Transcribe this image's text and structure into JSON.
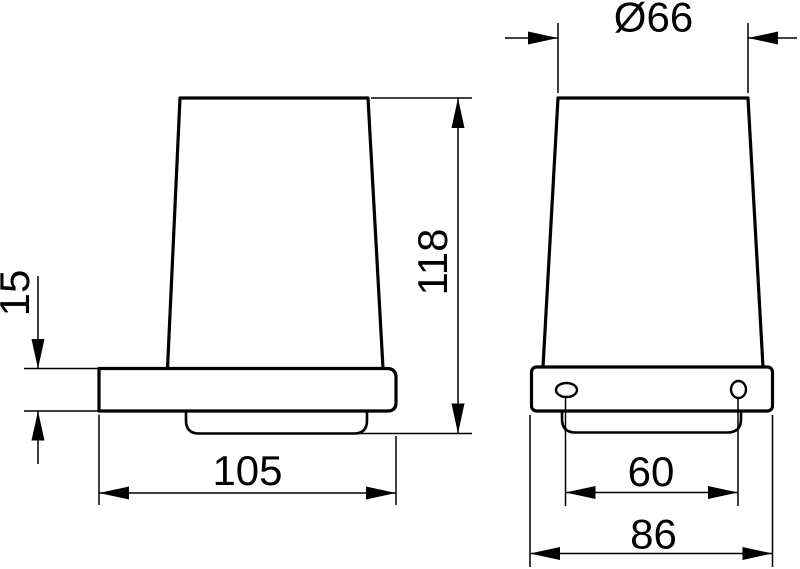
{
  "drawing": {
    "background_color": "#ffffff",
    "line_color": "#000000",
    "views": {
      "side": {
        "dimensions": {
          "bracket_thickness": {
            "label": "15",
            "value": 15
          },
          "total_height": {
            "label": "118",
            "value": 118
          },
          "depth": {
            "label": "105",
            "value": 105
          }
        }
      },
      "front": {
        "dimensions": {
          "top_diameter": {
            "label": "Ø66",
            "value": 66
          },
          "hole_spacing": {
            "label": "60",
            "value": 60
          },
          "holder_width": {
            "label": "86",
            "value": 86
          }
        }
      }
    }
  }
}
